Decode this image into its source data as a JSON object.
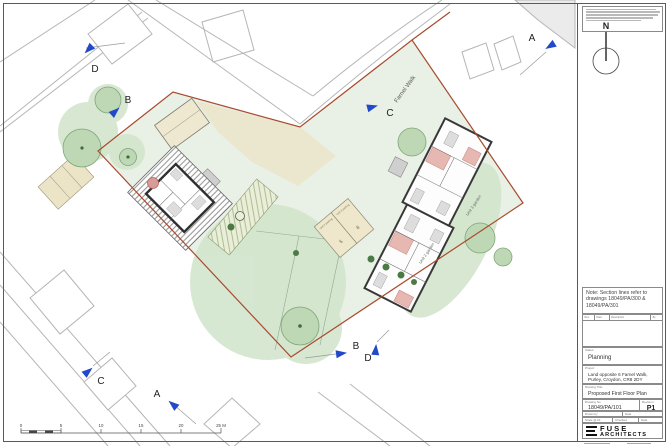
{
  "colors": {
    "site_green": "#e9f0e5",
    "blob_green": "#d3e5cd",
    "tree_green": "#bed8b5",
    "bush_green": "#4c7a44",
    "boundary_red": "#a84a2e",
    "marker_blue": "#2149c8",
    "parking_tan": "#efe7cb",
    "wall_dark": "#383838",
    "stair_pink": "#e7b7b2"
  },
  "plan": {
    "street": "Farnel Walk",
    "markers": [
      {
        "letter": "D"
      },
      {
        "letter": "B"
      },
      {
        "letter": "C"
      },
      {
        "letter": "A"
      },
      {
        "letter": "C"
      },
      {
        "letter": "A"
      },
      {
        "letter": "B"
      },
      {
        "letter": "D"
      }
    ],
    "gardens": {
      "unit2": "Unit 2 garden",
      "unit3": "Unit 3 garden"
    },
    "parking": {
      "unit2": "Unit 2 parking",
      "unit3": "Unit 3 parking",
      "bay5": "5",
      "bay6": "6"
    },
    "scale_ticks": [
      "0",
      "5",
      "10",
      "15",
      "20",
      "25 M"
    ]
  },
  "titleblock": {
    "north": "N",
    "note": "Note: Section lines refer to drawings 18049/PA/300 & 18049/PA/301",
    "rev_cols": [
      "Rev",
      "Date",
      "Description",
      "By"
    ],
    "status": {
      "label": "Status",
      "value": "Planning"
    },
    "project": {
      "label": "Project",
      "value": "Land opposite 6 Farnel Walk, Purley, Croydon, CR8 2DY"
    },
    "drawing_title": {
      "label": "Drawing Title",
      "value": "Proposed First Floor Plan"
    },
    "drawing_no": {
      "label": "Drawing No",
      "value": "18049/PA/101"
    },
    "revision": {
      "label": "Revision",
      "value": "P1"
    },
    "fields": {
      "drawn": "Drawn by",
      "date1": "Date",
      "scale": "Scale @ A1",
      "checked": "Checked",
      "date2": "Date"
    },
    "logo": {
      "line1": "FUSE",
      "line2": "ARCHITECTS"
    }
  }
}
